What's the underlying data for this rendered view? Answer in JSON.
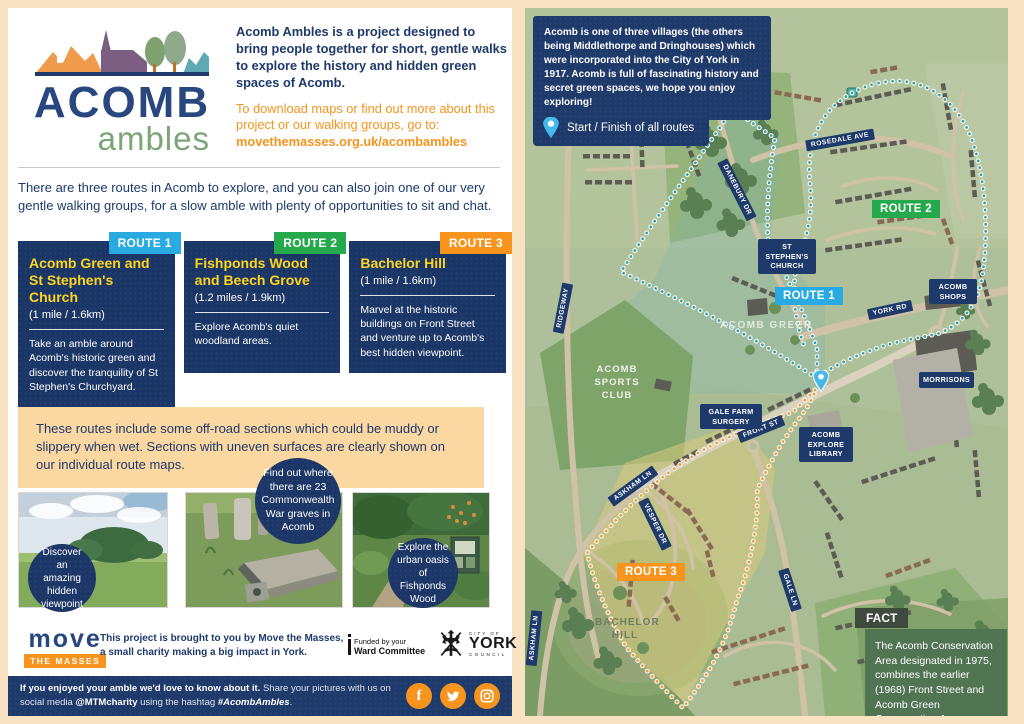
{
  "colors": {
    "navy": "#1d3a6b",
    "orange": "#f7941e",
    "yellow": "#ffd41f",
    "route1": "#29abe2",
    "route2": "#26a94c",
    "route3": "#f7941e",
    "peach_bg": "#f9e2c2",
    "warning_bg": "#fbd7a2",
    "logo_green": "#7ba577"
  },
  "left": {
    "logo": {
      "word": "ACOMB",
      "sub": "ambles"
    },
    "header": {
      "lead": "Acomb Ambles is a project designed to bring people together for short, gentle walks to explore the history and hidden green spaces of Acomb.",
      "cta": "To download maps or find out more about this project or our walking groups, go to:",
      "cta_link": "movethemasses.org.uk/acombambles"
    },
    "intro": "There are three routes in Acomb to explore, and you can also join one of our very gentle walking groups, for a slow amble with plenty of opportunities to sit and chat.",
    "routes": [
      {
        "badge": "ROUTE 1",
        "color": "#29abe2",
        "title": "Acomb Green and St Stephen's Church",
        "distance": "(1 mile / 1.6km)",
        "desc": "Take an amble around Acomb's historic green and discover the tranquility of St Stephen's Churchyard."
      },
      {
        "badge": "ROUTE 2",
        "color": "#26a94c",
        "title": "Fishponds Wood and Beech Grove",
        "distance": "(1.2 miles / 1.9km)",
        "desc": "Explore Acomb's quiet woodland areas."
      },
      {
        "badge": "ROUTE 3",
        "color": "#f7941e",
        "title": "Bachelor Hill",
        "distance": "(1 mile / 1.6km)",
        "desc": "Marvel at the historic buildings on Front Street and venture up to Acomb's best hidden viewpoint."
      }
    ],
    "warning": "These routes include some off-road sections which could be muddy or slippery when wet. Sections with uneven surfaces are clearly shown on our individual route maps.",
    "bubbles": [
      "Discover an amazing hidden viewpoint",
      "Find out where there are 23 Commonwealth War graves in Acomb",
      "Explore the urban oasis of Fishponds Wood"
    ],
    "credits": {
      "logo_word": "move",
      "logo_band": "THE MASSES",
      "text": "This project is brought to you by Move the Masses, a small charity making a big impact in York.",
      "ward_line1": "Funded by your",
      "ward_line2": "Ward Committee",
      "york_top": "CITY OF",
      "york_main": "YORK",
      "york_bottom": "COUNCIL"
    },
    "footer": {
      "bold": "If you enjoyed your amble we'd love to know about it.",
      "mid": " Share your pictures with us on social media ",
      "handle": "@MTMcharity",
      "mid2": " using the hashtag ",
      "hashtag": "#AcombAmbles",
      "end": "."
    },
    "icons": {
      "facebook": "f"
    }
  },
  "map": {
    "info": "Acomb is one of three villages (the others being Middlethorpe and Dringhouses) which were incorporated into the City of York in 1917. Acomb is full of fascinating history and secret green spaces, we hope you enjoy exploring!",
    "legend": "Start / Finish of all routes",
    "badges": [
      "ROUTE 1",
      "ROUTE 2",
      "ROUTE 3"
    ],
    "streets": [
      "DANEBURY DR",
      "ROSEDALE AVE",
      "RIDGEWAY",
      "YORK RD",
      "FRONT ST",
      "ASKHAM LN",
      "VESPER DR",
      "GALE LN"
    ],
    "places": [
      "ST STEPHEN'S CHURCH",
      "ACOMB SHOPS",
      "GALE FARM SURGERY",
      "MORRISONS",
      "ACOMB EXPLORE LIBRARY"
    ],
    "areas": [
      "ACOMB GREEN",
      "ACOMB SPORTS CLUB",
      "BACHELOR HILL"
    ],
    "fact": {
      "tab": "FACT",
      "text": "The Acomb Conservation Area designated in 1975, combines the earlier (1968) Front Street and Acomb Green Conservation Areas."
    }
  }
}
